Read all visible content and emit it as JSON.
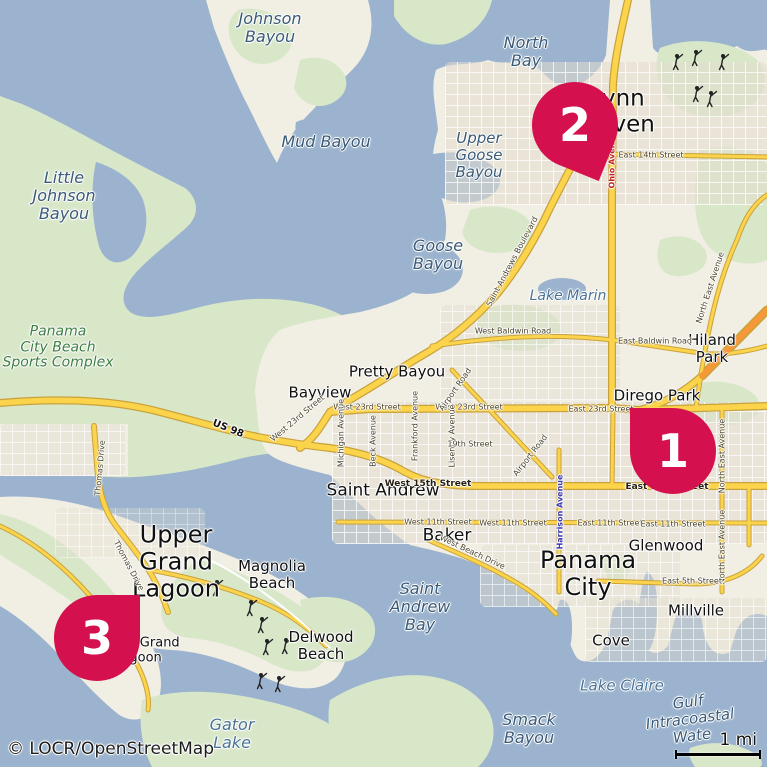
{
  "theme": {
    "water": "#9bb3ce",
    "land": "#f1eee3",
    "green": "#d9e7c9",
    "road-yellow": "#fbd44c",
    "road-casing": "#c9a23c",
    "road-orange": "#f59838",
    "marker": "#d4114e"
  },
  "markers": [
    {
      "number": "1",
      "location_label": "Dirego Park / East 23rd Street"
    },
    {
      "number": "2",
      "location_label": "Lynn Haven"
    },
    {
      "number": "3",
      "location_label": "Upper Grand Lagoon"
    }
  ],
  "attribution": "© LOCR/OpenStreetMap",
  "scale": {
    "label": "1 mi"
  },
  "labels": [
    {
      "name": "label-johnson-bayou",
      "text": "Johnson\nBayou",
      "x": 270,
      "y": 28,
      "fs": 16,
      "cls": "water"
    },
    {
      "name": "label-little-johnson-bayou",
      "text": "Little\nJohnson\nBayou",
      "x": 64,
      "y": 196,
      "fs": 16,
      "cls": "water"
    },
    {
      "name": "label-mud-bayou",
      "text": "Mud Bayou",
      "x": 326,
      "y": 142,
      "fs": 16,
      "cls": "water"
    },
    {
      "name": "label-north-bay",
      "text": "North\nBay",
      "x": 526,
      "y": 52,
      "fs": 16,
      "cls": "water"
    },
    {
      "name": "label-upper-goose-bayou",
      "text": "Upper\nGoose\nBayou",
      "x": 479,
      "y": 155,
      "fs": 15,
      "cls": "water"
    },
    {
      "name": "label-goose-bayou",
      "text": "Goose\nBayou",
      "x": 438,
      "y": 255,
      "fs": 16,
      "cls": "water"
    },
    {
      "name": "label-lake-marin",
      "text": "Lake Marin",
      "x": 568,
      "y": 297,
      "fs": 14,
      "cls": "water2"
    },
    {
      "name": "label-saint-andrew-bay",
      "text": "Saint\nAndrew\nBay",
      "x": 420,
      "y": 607,
      "fs": 16,
      "cls": "water"
    },
    {
      "name": "label-gator-lake",
      "text": "Gator\nLake",
      "x": 232,
      "y": 734,
      "fs": 16,
      "cls": "water2"
    },
    {
      "name": "label-smack-bayou",
      "text": "Smack\nBayou",
      "x": 529,
      "y": 729,
      "fs": 16,
      "cls": "water"
    },
    {
      "name": "label-lake-claire",
      "text": "Lake Claire",
      "x": 622,
      "y": 686,
      "fs": 15,
      "cls": "water2"
    },
    {
      "name": "label-gulf-intracoastal-waterway",
      "text": "Gulf Intracoastal Wate",
      "x": 690,
      "y": 719,
      "fs": 15,
      "cls": "water",
      "rot": -7
    },
    {
      "name": "label-sports-complex",
      "text": "Panama\nCity Beach\nSports Complex",
      "x": 58,
      "y": 348,
      "fs": 14,
      "cls": "green-label"
    },
    {
      "name": "label-lynn-haven",
      "text": "Lynn\nHaven",
      "x": 618,
      "y": 112,
      "fs": 23,
      "cls": "place"
    },
    {
      "name": "label-hiland-park",
      "text": "Hiland Park",
      "x": 712,
      "y": 349,
      "fs": 15,
      "cls": "place"
    },
    {
      "name": "label-dirego-park",
      "text": "Dirego Park",
      "x": 657,
      "y": 396,
      "fs": 15,
      "cls": "place"
    },
    {
      "name": "label-bayview",
      "text": "Bayview",
      "x": 320,
      "y": 393,
      "fs": 15,
      "cls": "place"
    },
    {
      "name": "label-pretty-bayou",
      "text": "Pretty Bayou",
      "x": 397,
      "y": 372,
      "fs": 15,
      "cls": "place"
    },
    {
      "name": "label-saint-andrew",
      "text": "Saint Andrew",
      "x": 383,
      "y": 491,
      "fs": 17,
      "cls": "place"
    },
    {
      "name": "label-baker",
      "text": "Baker",
      "x": 447,
      "y": 536,
      "fs": 17,
      "cls": "place"
    },
    {
      "name": "label-panama-city",
      "text": "Panama\nCity",
      "x": 588,
      "y": 574,
      "fs": 24,
      "cls": "place"
    },
    {
      "name": "label-glenwood",
      "text": "Glenwood",
      "x": 666,
      "y": 546,
      "fs": 15,
      "cls": "place"
    },
    {
      "name": "label-millville",
      "text": "Millville",
      "x": 696,
      "y": 611,
      "fs": 15,
      "cls": "place"
    },
    {
      "name": "label-cove",
      "text": "Cove",
      "x": 611,
      "y": 641,
      "fs": 15,
      "cls": "place"
    },
    {
      "name": "label-upper-grand-lagoon",
      "text": "Upper\nGrand\nLagoon",
      "x": 176,
      "y": 562,
      "fs": 24,
      "cls": "place"
    },
    {
      "name": "label-magnolia-beach",
      "text": "Magnolia\nBeach",
      "x": 272,
      "y": 575,
      "fs": 15,
      "cls": "place"
    },
    {
      "name": "label-delwood-beach",
      "text": "Delwood\nBeach",
      "x": 321,
      "y": 646,
      "fs": 15,
      "cls": "place"
    },
    {
      "name": "label-upper-grand-lagoon-small",
      "text": "Upper Grand\nLagoon",
      "x": 138,
      "y": 651,
      "fs": 13,
      "cls": "place"
    },
    {
      "name": "label-east-14th-street",
      "text": "East 14th Street",
      "x": 651,
      "y": 156,
      "fs": 8,
      "cls": "street"
    },
    {
      "name": "label-ohio-avenue",
      "text": "Ohio Avenue",
      "x": 613,
      "y": 160,
      "fs": 8,
      "cls": "street-red",
      "rot": -90
    },
    {
      "name": "label-saint-andrews-boulevard",
      "text": "Saint Andrews Boulevard",
      "x": 513,
      "y": 262,
      "fs": 8,
      "cls": "street",
      "rot": -62
    },
    {
      "name": "label-west-baldwin-road",
      "text": "West Baldwin Road",
      "x": 513,
      "y": 332,
      "fs": 8,
      "cls": "street"
    },
    {
      "name": "label-east-baldwin-road",
      "text": "East Baldwin Road",
      "x": 655,
      "y": 342,
      "fs": 8,
      "cls": "street"
    },
    {
      "name": "label-north-east-avenue-1",
      "text": "North East Avenue",
      "x": 711,
      "y": 288,
      "fs": 8,
      "cls": "street",
      "rot": -72
    },
    {
      "name": "label-north-east-avenue-2",
      "text": "North East Avenue",
      "x": 723,
      "y": 456,
      "fs": 8,
      "cls": "street",
      "rot": -90
    },
    {
      "name": "label-north-east-avenue-3",
      "text": "North East Avenue",
      "x": 723,
      "y": 547,
      "fs": 8,
      "cls": "street",
      "rot": -90
    },
    {
      "name": "label-west-23rd-street-diag",
      "text": "West 23rd Street",
      "x": 298,
      "y": 419,
      "fs": 8,
      "cls": "street",
      "rot": -40
    },
    {
      "name": "label-west-23rd-street-1",
      "text": "West 23rd Street",
      "x": 367,
      "y": 408,
      "fs": 8,
      "cls": "street"
    },
    {
      "name": "label-west-23rd-street-2",
      "text": "West 23rd Street",
      "x": 469,
      "y": 408,
      "fs": 8,
      "cls": "street"
    },
    {
      "name": "label-east-23rd-street",
      "text": "East 23rd Street",
      "x": 601,
      "y": 410,
      "fs": 8,
      "cls": "street"
    },
    {
      "name": "label-us-98",
      "text": "US 98",
      "x": 228,
      "y": 429,
      "fs": 10,
      "cls": "street-us",
      "rot": 22
    },
    {
      "name": "label-thomas-drive-1",
      "text": "Thomas Drive",
      "x": 101,
      "y": 468,
      "fs": 8,
      "cls": "street",
      "rot": -85
    },
    {
      "name": "label-thomas-drive-2",
      "text": "Thomas Drive",
      "x": 128,
      "y": 566,
      "fs": 8,
      "cls": "street",
      "rot": 62
    },
    {
      "name": "label-michigan-avenue",
      "text": "Michigan Avenue",
      "x": 342,
      "y": 433,
      "fs": 8,
      "cls": "street",
      "rot": -90
    },
    {
      "name": "label-beck-avenue",
      "text": "Beck Avenue",
      "x": 374,
      "y": 441,
      "fs": 8,
      "cls": "street",
      "rot": -90
    },
    {
      "name": "label-frankford-avenue",
      "text": "Frankford Avenue",
      "x": 416,
      "y": 426,
      "fs": 8,
      "cls": "street",
      "rot": -90
    },
    {
      "name": "label-lisenby-avenue",
      "text": "Lisenby Avenue",
      "x": 453,
      "y": 436,
      "fs": 8,
      "cls": "street",
      "rot": -90
    },
    {
      "name": "label-airport-road-1",
      "text": "Airport Road",
      "x": 456,
      "y": 390,
      "fs": 8,
      "cls": "street",
      "rot": -55
    },
    {
      "name": "label-airport-road-2",
      "text": "Airport Road",
      "x": 531,
      "y": 456,
      "fs": 8,
      "cls": "street",
      "rot": -52
    },
    {
      "name": "label-19th-street",
      "text": "19th Street",
      "x": 470,
      "y": 445,
      "fs": 8,
      "cls": "street"
    },
    {
      "name": "label-west-15th-street",
      "text": "West 15th Street",
      "x": 428,
      "y": 484,
      "fs": 9,
      "cls": "street-bold"
    },
    {
      "name": "label-east-15th-street",
      "text": "East 15th Street",
      "x": 667,
      "y": 487,
      "fs": 9,
      "cls": "street-bold"
    },
    {
      "name": "label-harrison-avenue",
      "text": "Harrison Avenue",
      "x": 561,
      "y": 512,
      "fs": 8,
      "cls": "street-blue",
      "rot": -90
    },
    {
      "name": "label-west-11th-street-1",
      "text": "West 11th Street",
      "x": 438,
      "y": 523,
      "fs": 8,
      "cls": "street"
    },
    {
      "name": "label-west-11th-street-2",
      "text": "West 11th Street",
      "x": 513,
      "y": 524,
      "fs": 8,
      "cls": "street"
    },
    {
      "name": "label-east-11th-street-1",
      "text": "East 11th Street",
      "x": 610,
      "y": 524,
      "fs": 8,
      "cls": "street"
    },
    {
      "name": "label-east-11th-street-2",
      "text": "East 11th Street",
      "x": 673,
      "y": 525,
      "fs": 8,
      "cls": "street"
    },
    {
      "name": "label-west-beach-drive",
      "text": "West Beach Drive",
      "x": 472,
      "y": 553,
      "fs": 8,
      "cls": "street",
      "rot": 25
    },
    {
      "name": "label-east-5th-street",
      "text": "East 5th Street",
      "x": 692,
      "y": 582,
      "fs": 8,
      "cls": "street"
    }
  ],
  "golfers": [
    {
      "x": 678,
      "y": 62
    },
    {
      "x": 697,
      "y": 58
    },
    {
      "x": 724,
      "y": 62
    },
    {
      "x": 698,
      "y": 94
    },
    {
      "x": 712,
      "y": 99
    },
    {
      "x": 218,
      "y": 588
    },
    {
      "x": 252,
      "y": 608
    },
    {
      "x": 263,
      "y": 625
    },
    {
      "x": 268,
      "y": 647
    },
    {
      "x": 287,
      "y": 646
    },
    {
      "x": 262,
      "y": 681
    },
    {
      "x": 280,
      "y": 684
    }
  ]
}
